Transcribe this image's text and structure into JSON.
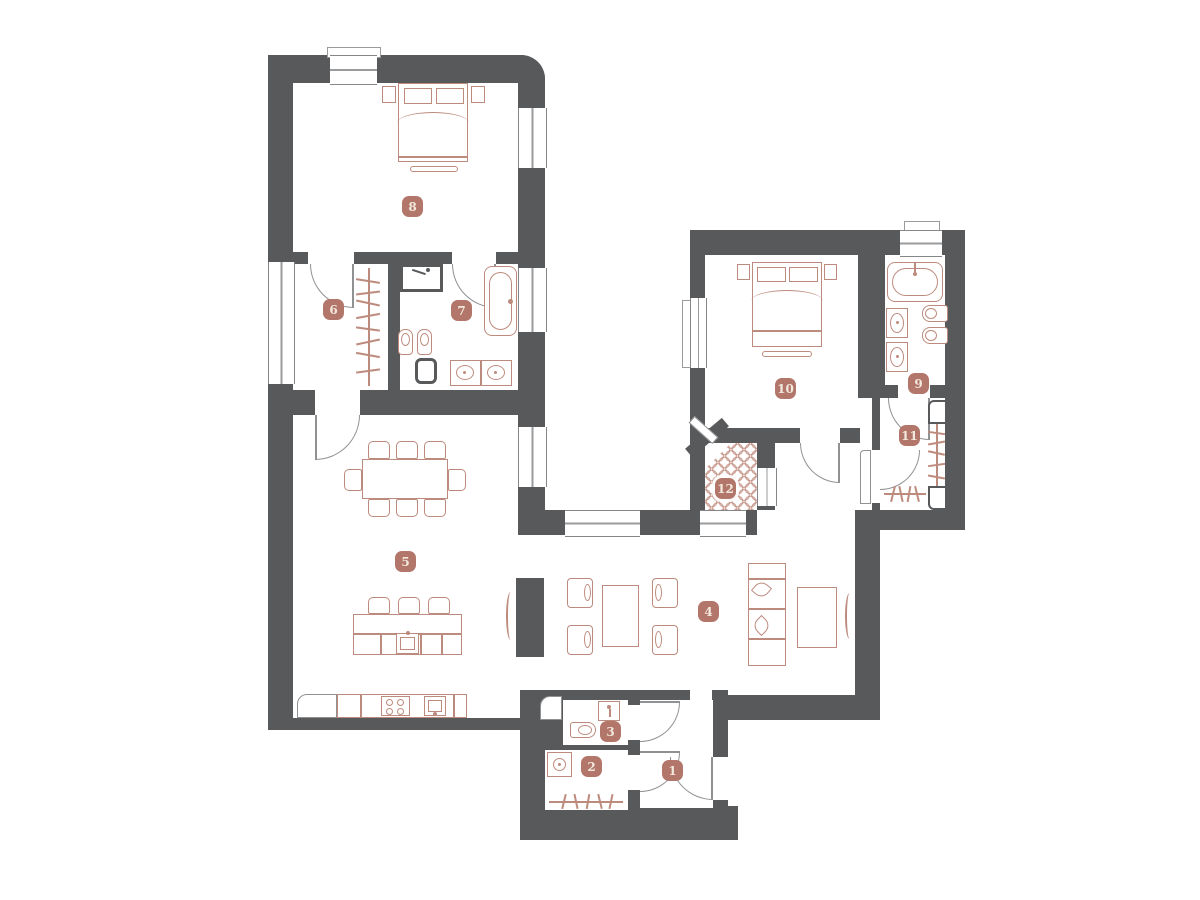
{
  "rooms": [
    {
      "label": "1"
    },
    {
      "label": "2"
    },
    {
      "label": "3"
    },
    {
      "label": "4"
    },
    {
      "label": "5"
    },
    {
      "label": "6"
    },
    {
      "label": "7"
    },
    {
      "label": "8"
    },
    {
      "label": "9"
    },
    {
      "label": "10"
    },
    {
      "label": "11"
    },
    {
      "label": "12"
    }
  ],
  "colors": {
    "wall": "#58595b",
    "badge_background": "#b2766a",
    "badge_text": "#f2e8dc",
    "furniture_outline": "#bd8b7d",
    "door_line": "#909193",
    "background": "#ffffff"
  }
}
